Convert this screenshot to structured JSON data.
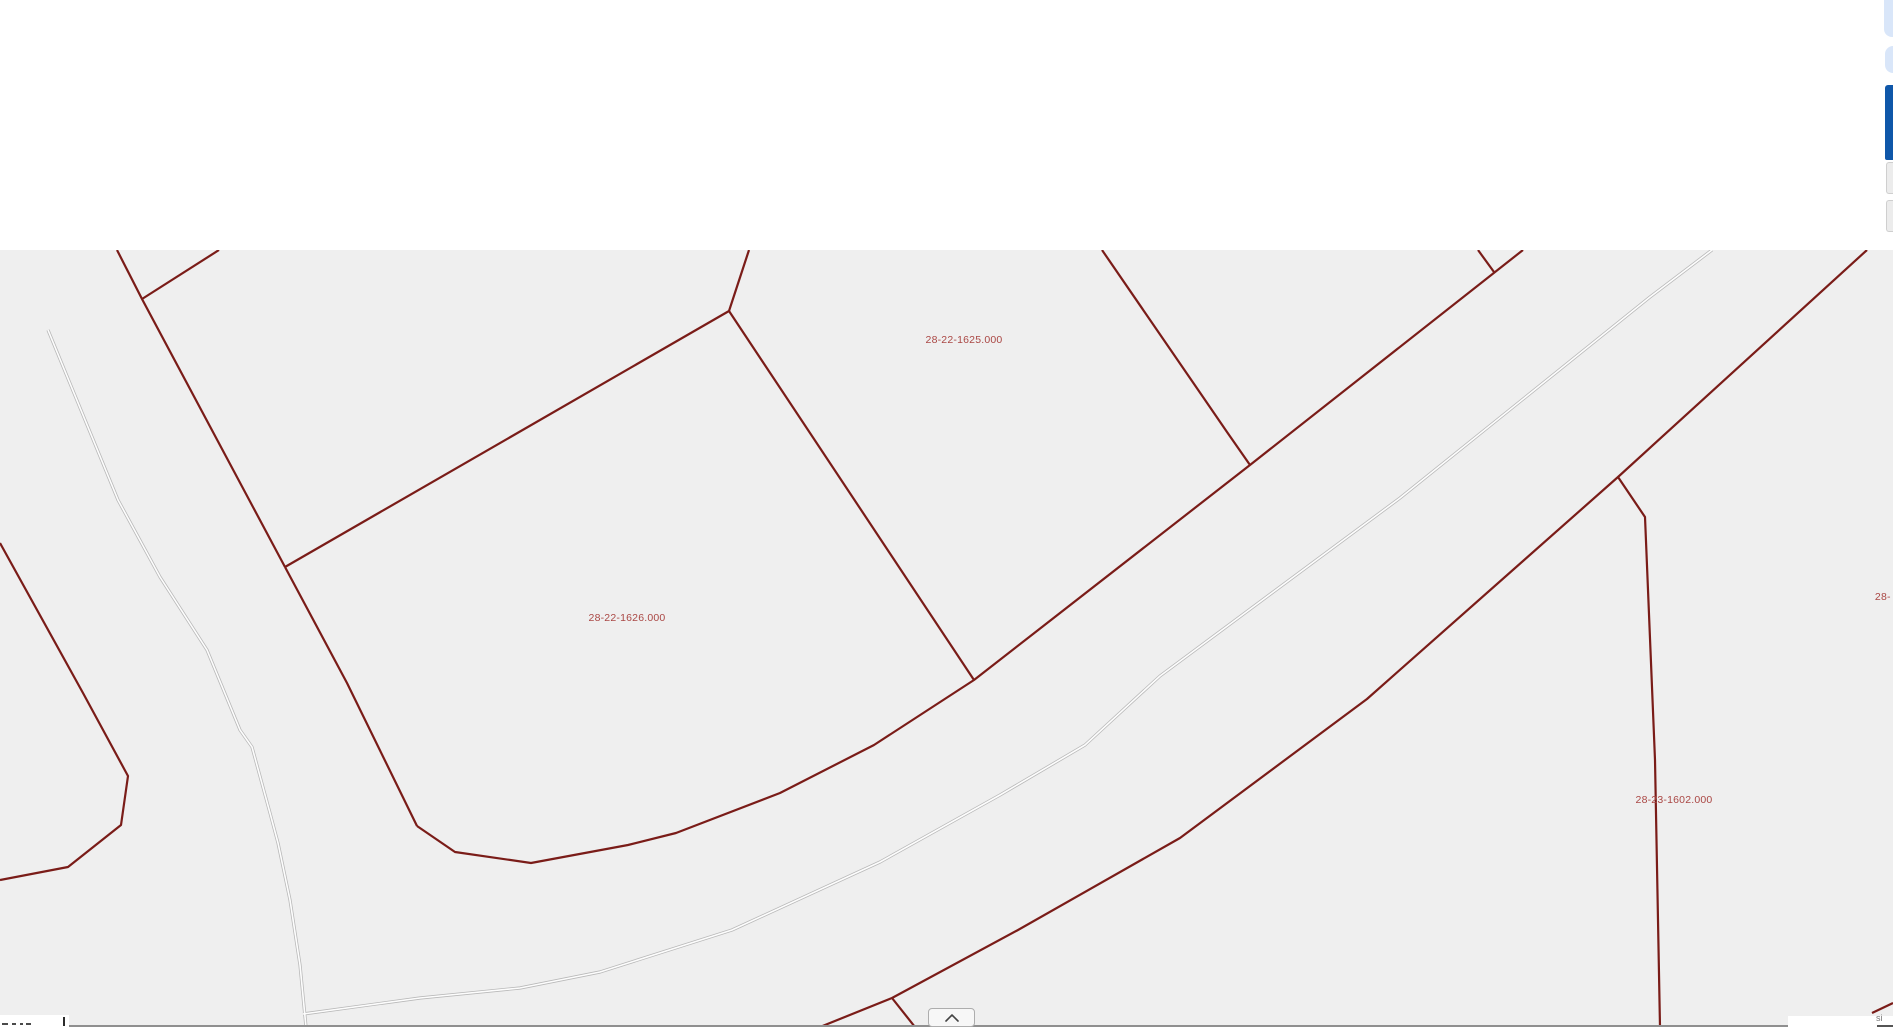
{
  "header": {
    "note": ""
  },
  "map": {
    "background": "#efefef",
    "parcel_line_color": "#7a1c18",
    "road_casing_color": "#b9b9b9",
    "road_core_color": "#fdfdfd",
    "label_color": "#aa4744",
    "labels": [
      {
        "text": "28-22-1625.000",
        "x": 964,
        "y": 340,
        "clipped": "none"
      },
      {
        "text": "28-22-1626.000",
        "x": 627,
        "y": 618,
        "clipped": "none"
      },
      {
        "text": "28-23-1602.000",
        "x": 1674,
        "y": 800,
        "clipped": "none"
      },
      {
        "text": "28-",
        "x": 1884,
        "y": 597,
        "clipped": "right"
      },
      {
        "text": "28-22-1624.000",
        "x": 548,
        "y": 246.5,
        "clipped": "top"
      }
    ],
    "parcel_lines": [
      [
        [
          117,
          250
        ],
        [
          142,
          299
        ],
        [
          285,
          567
        ]
      ],
      [
        [
          142,
          299
        ],
        [
          219,
          250
        ]
      ],
      [
        [
          285,
          567
        ],
        [
          729,
          311
        ]
      ],
      [
        [
          729,
          311
        ],
        [
          749,
          250
        ]
      ],
      [
        [
          285,
          567
        ],
        [
          347,
          683
        ],
        [
          417,
          826
        ]
      ],
      [
        [
          729,
          311
        ],
        [
          974,
          680
        ]
      ],
      [
        [
          417,
          826
        ],
        [
          455,
          852
        ],
        [
          531,
          863
        ],
        [
          628,
          845
        ],
        [
          676,
          833
        ],
        [
          780,
          793
        ],
        [
          874,
          745
        ],
        [
          974,
          680
        ],
        [
          1250,
          465
        ],
        [
          1523,
          250
        ]
      ],
      [
        [
          1102,
          250
        ],
        [
          1203,
          397
        ],
        [
          1227,
          432
        ],
        [
          1250,
          465
        ]
      ],
      [
        [
          1478,
          250
        ],
        [
          1494,
          272
        ]
      ],
      [
        [
          820,
          1027
        ],
        [
          892,
          998
        ],
        [
          1018,
          930
        ],
        [
          1180,
          838
        ],
        [
          1367,
          699
        ],
        [
          1618,
          477
        ],
        [
          1867,
          250
        ]
      ],
      [
        [
          892,
          998
        ],
        [
          915,
          1027
        ]
      ],
      [
        [
          1618,
          477
        ],
        [
          1645,
          517
        ],
        [
          1655,
          760
        ],
        [
          1660,
          1027
        ]
      ],
      [
        [
          0,
          543
        ],
        [
          83,
          693
        ],
        [
          128,
          776
        ],
        [
          121,
          825
        ],
        [
          68,
          867
        ],
        [
          0,
          880
        ]
      ],
      [
        [
          1872,
          1013
        ],
        [
          1893,
          1003
        ]
      ]
    ],
    "road_center_lines": [
      [
        [
          48,
          330
        ],
        [
          118,
          500
        ],
        [
          160,
          577
        ],
        [
          207,
          650
        ],
        [
          240,
          730
        ],
        [
          252,
          747
        ],
        [
          270,
          813
        ],
        [
          278,
          843
        ],
        [
          290,
          900
        ],
        [
          300,
          965
        ],
        [
          306,
          1027
        ]
      ],
      [
        [
          303,
          1014
        ],
        [
          420,
          998
        ],
        [
          520,
          988
        ],
        [
          600,
          972
        ],
        [
          732,
          930
        ],
        [
          880,
          862
        ],
        [
          1000,
          795
        ],
        [
          1085,
          745
        ],
        [
          1160,
          676
        ],
        [
          1400,
          498
        ],
        [
          1650,
          297
        ],
        [
          1712,
          250
        ]
      ]
    ]
  },
  "controls": {
    "expand_button": {
      "icon": "chevron-up"
    },
    "right_edge": {
      "color_light": "#d9e6f9",
      "color_dark": "#0f57a9"
    }
  },
  "scale_bar": {
    "tick": true
  },
  "attribution": {
    "fragment": "si"
  }
}
